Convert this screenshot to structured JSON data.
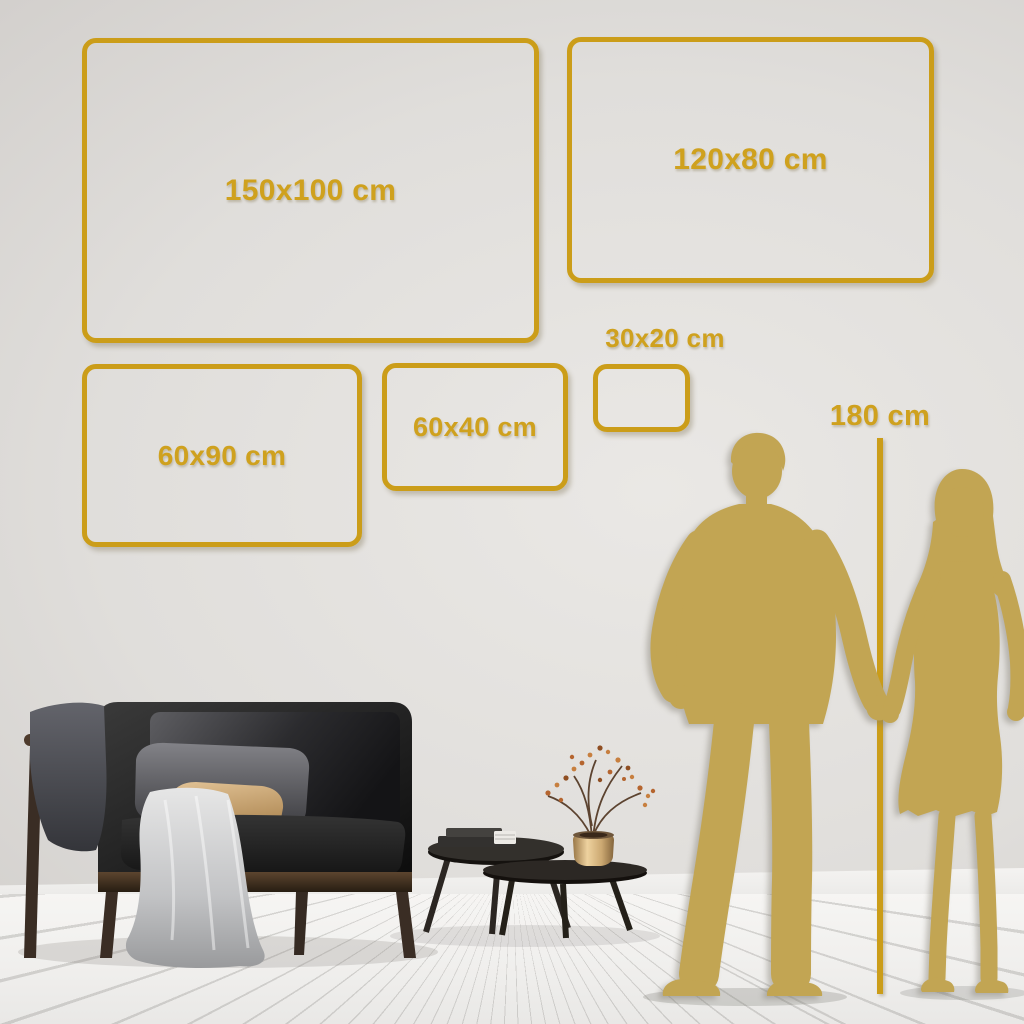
{
  "colors": {
    "gold": "#CB9D19",
    "gold-text": "#CFA11E",
    "silhouette": "#C2A553"
  },
  "boxes": {
    "b150": {
      "label": "150x100 cm"
    },
    "b120": {
      "label": "120x80 cm"
    },
    "b6090": {
      "label": "60x90 cm"
    },
    "b6040": {
      "label": "60x40 cm"
    },
    "b3020": {
      "label": "30x20 cm"
    }
  },
  "ruler": {
    "label": "180 cm"
  },
  "scene": {
    "items": [
      "wall",
      "floor",
      "sofa",
      "gray-blanket",
      "throw-blanket",
      "pillows",
      "nesting-coffee-tables",
      "books",
      "brass-vase-with-branch",
      "man-silhouette",
      "woman-silhouette",
      "height-ruler"
    ]
  }
}
